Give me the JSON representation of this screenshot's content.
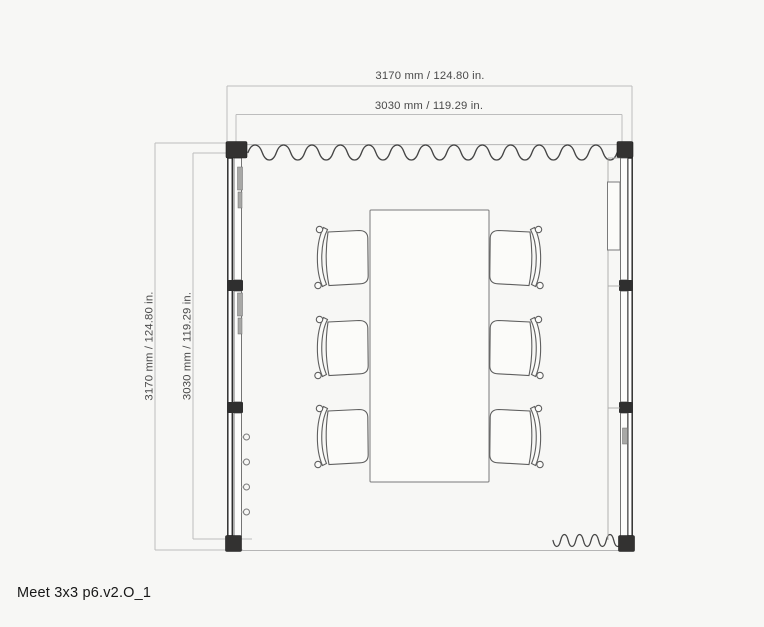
{
  "title": "Meet 3x3 p6.v2.O_1",
  "dimensions": {
    "top_outer": "3170 mm / 124.80 in.",
    "top_inner": "3030 mm / 119.29 in.",
    "left_outer": "3170 mm / 124.80 in.",
    "left_inner": "3030 mm / 119.29 in."
  },
  "plan": {
    "view": "top-view floor plan",
    "chair_count": 6,
    "table_count": 1,
    "wall_features": [
      "curtain-top-wall",
      "left-glass-wall-3-panels",
      "right-glass-wall-with-screen",
      "coat-hooks",
      "corner-posts",
      "curtain-bottom-right"
    ]
  },
  "colors": {
    "background": "#f7f7f5",
    "dimension_line": "#bdbdbd",
    "dimension_text": "#4a4a4a",
    "wall_dark": "#2f2f2f",
    "drawing_line": "#666666"
  }
}
